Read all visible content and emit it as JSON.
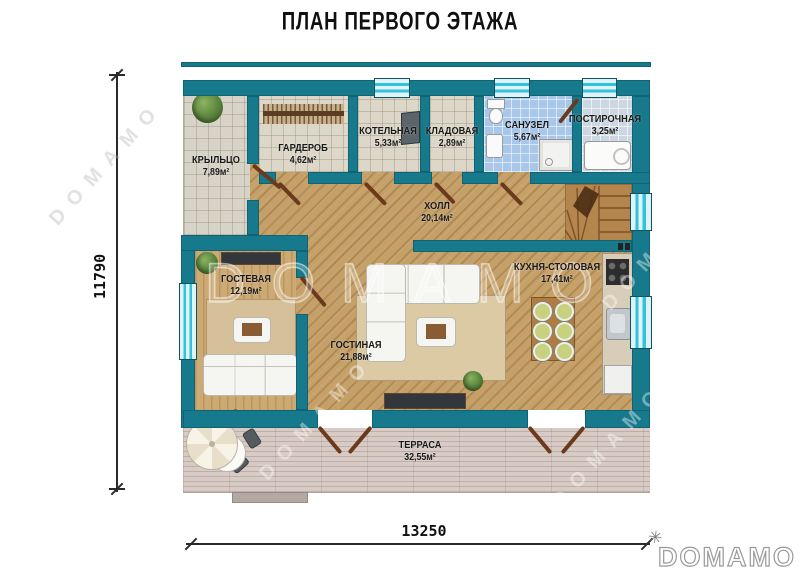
{
  "title": "ПЛАН ПЕРВОГО ЭТАЖА",
  "brand": {
    "logo": "DOMAMO",
    "watermark": "DOMAMO",
    "logo_mark": "✳"
  },
  "dimensions": {
    "height_mm": "11790",
    "width_mm": "13250"
  },
  "rooms": [
    {
      "id": "porch",
      "name": "КРЫЛЬЦО",
      "area": "7,89м²"
    },
    {
      "id": "wardrobe",
      "name": "ГАРДЕРОБ",
      "area": "4,62м²"
    },
    {
      "id": "boiler",
      "name": "КОТЕЛЬНАЯ",
      "area": "5,33м²"
    },
    {
      "id": "storage",
      "name": "КЛАДОВАЯ",
      "area": "2,89м²"
    },
    {
      "id": "bathroom",
      "name": "САНУЗЕЛ",
      "area": "5,67м²"
    },
    {
      "id": "laundry",
      "name": "ПОСТИРОЧНАЯ",
      "area": "3,25м²"
    },
    {
      "id": "hall",
      "name": "ХОЛЛ",
      "area": "20,14м²"
    },
    {
      "id": "guest",
      "name": "ГОСТЕВАЯ",
      "area": "12,19м²"
    },
    {
      "id": "living",
      "name": "ГОСТИНАЯ",
      "area": "21,88м²"
    },
    {
      "id": "kitchen",
      "name": "КУХНЯ-СТОЛОВАЯ",
      "area": "17,41м²"
    },
    {
      "id": "terrace",
      "name": "ТЕРРАСА",
      "area": "32,55м²"
    }
  ],
  "colors": {
    "wall": "#16798c",
    "window_glass": "#dff2f7",
    "window_stripe": "#31c3da",
    "wood": "#c5a068",
    "tile": "#ddd7c9",
    "bath": "#a9c7e9",
    "laundry": "#ccd7e1",
    "terrace": "#d8cbc5",
    "rug": "#d6c099",
    "door": "#6b3a1c"
  }
}
